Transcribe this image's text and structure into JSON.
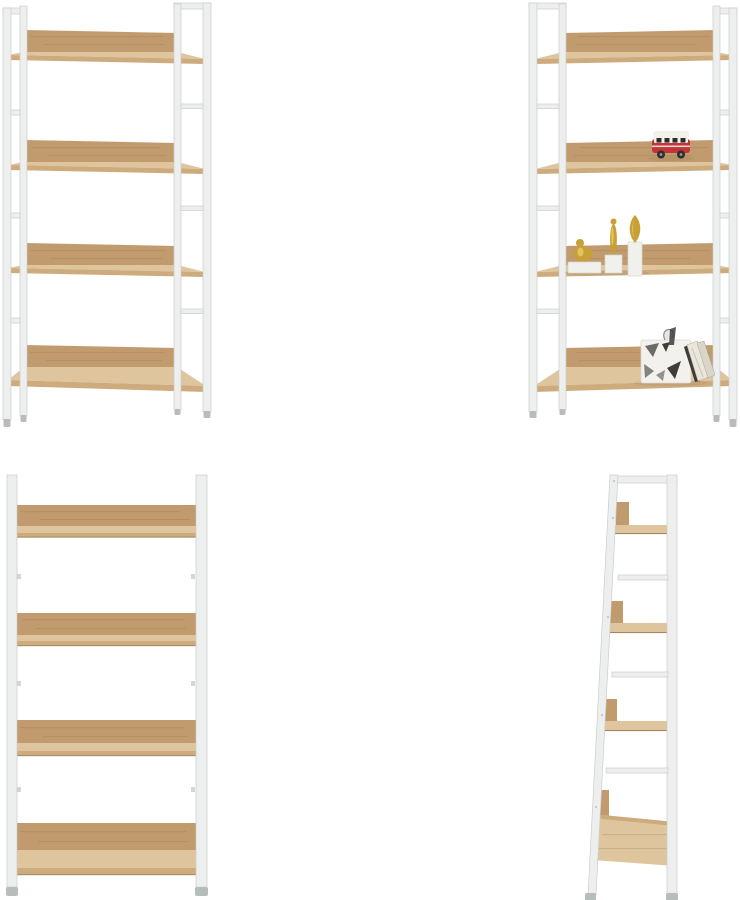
{
  "canvas": {
    "width_px": 740,
    "height_px": 900,
    "background": "#ffffff",
    "grid_rows": 2,
    "grid_cols": 2
  },
  "gallery": {
    "product": {
      "shelf_tiers": 4,
      "frame_style": "white-metal-ladder",
      "shelf_material": "light-oak-wood"
    },
    "views": [
      {
        "id": "angled-empty",
        "position": "top-left",
        "label": "Four-tier shelf, angled front view, empty"
      },
      {
        "id": "angled-decorated",
        "position": "top-right",
        "label": "Four-tier shelf, angled front view, styled with decor",
        "decorations": [
          "red-toy-bus",
          "gold-figurines-on-pedestals",
          "fabric-storage-box-with-books"
        ]
      },
      {
        "id": "front-empty",
        "position": "bottom-left",
        "label": "Four-tier shelf, straight front view, empty"
      },
      {
        "id": "side-profile",
        "position": "bottom-right",
        "label": "Four-tier shelf, side profile view"
      }
    ]
  },
  "colors": {
    "background": "#ffffff",
    "frame": "#edefee",
    "frame_line": "#c9cecb",
    "frame_dark": "#b7bdba",
    "wood_surface": "#dfc59e",
    "wood_board": "#c19b6e",
    "wood_edge": "#cdab7d",
    "wood_line": "#9d7b50",
    "wood_grain": "#8a6a42",
    "bus_red": "#c13438",
    "bus_dark": "#2e2e30",
    "bus_white": "#f4f1ea",
    "gold": "#c7a036",
    "gold_light": "#e6c964",
    "pedestal": "#f0f0ec",
    "pedestal_shade": "#d6d6d0",
    "basket_base": "#f2f1ed",
    "basket_pattern": "#55534e",
    "book_page": "#eae6da",
    "book_dark": "#3f3d38"
  }
}
